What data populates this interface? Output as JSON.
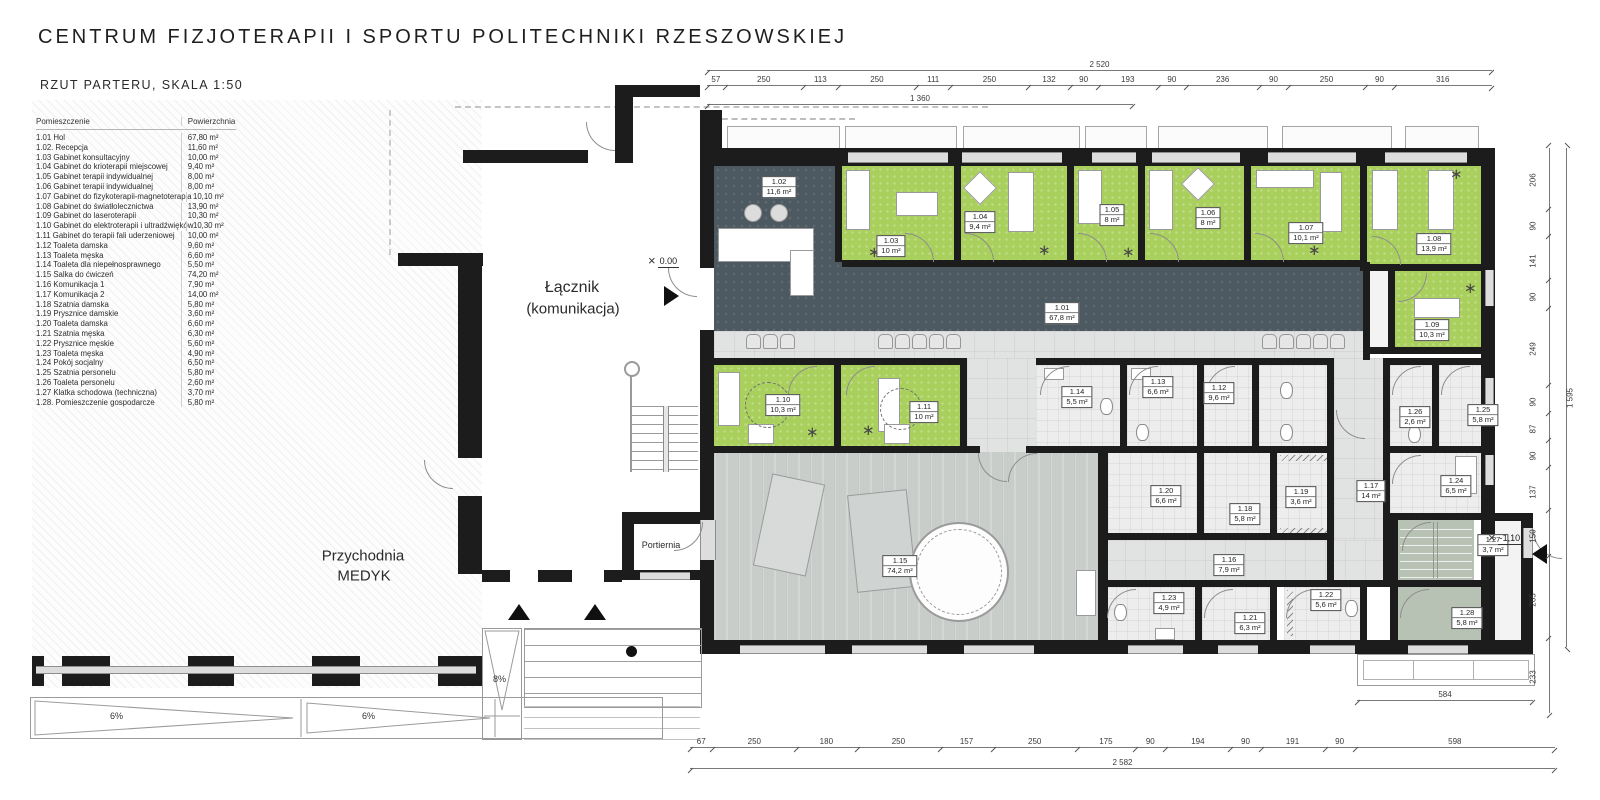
{
  "title": "CENTRUM FIZJOTERAPII I SPORTU POLITECHNIKI RZESZOWSKIEJ",
  "subtitle": "RZUT PARTERU, SKALA 1:50",
  "legend": {
    "col_room": "Pomieszczenie",
    "col_area": "Powierzchnia",
    "rows": [
      {
        "name": "1.01 Hol",
        "area": "67,80 m²"
      },
      {
        "name": "1.02. Recepcja",
        "area": "11,60 m²"
      },
      {
        "name": "1.03 Gabinet konsultacyjny",
        "area": "10,00 m²"
      },
      {
        "name": "1.04 Gabinet do krioterapii miejscowej",
        "area": "9,40 m²"
      },
      {
        "name": "1.05 Gabinet terapii indywidualnej",
        "area": "8,00 m²"
      },
      {
        "name": "1.06 Gabinet terapii indywidualnej",
        "area": "8,00 m²"
      },
      {
        "name": "1.07 Gabinet do fizykoterapii-magnetoterapia",
        "area": "10,10 m²"
      },
      {
        "name": "1.08 Gabinet do światłolecznictwa",
        "area": "13,90 m²"
      },
      {
        "name": "1.09 Gabinet do laseroterapii",
        "area": "10,30 m²"
      },
      {
        "name": "1.10 Gabinet do elektroterapii i ultradźwięków",
        "area": "10,30 m²"
      },
      {
        "name": "1.11 Gabinet do terapii fali uderzeniowej",
        "area": "10,00 m²"
      },
      {
        "name": "1.12 Toaleta damska",
        "area": "9,60 m²"
      },
      {
        "name": "1.13 Toaleta męska",
        "area": "6,60 m²"
      },
      {
        "name": "1.14 Toaleta dla niepełnosprawnego",
        "area": "5,50 m²"
      },
      {
        "name": "1.15 Salka do ćwiczeń",
        "area": "74,20 m²"
      },
      {
        "name": "1.16 Komunikacja 1",
        "area": "7,90 m²"
      },
      {
        "name": "1.17 Komunikacja 2",
        "area": "14,00 m²"
      },
      {
        "name": "1.18 Szatnia damska",
        "area": "5,80 m²"
      },
      {
        "name": "1.19 Prysznice damskie",
        "area": "3,60 m²"
      },
      {
        "name": "1.20 Toaleta damska",
        "area": "6,60 m²"
      },
      {
        "name": "1.21 Szatnia męska",
        "area": "6,30 m²"
      },
      {
        "name": "1.22 Prysznice męskie",
        "area": "5,60 m²"
      },
      {
        "name": "1.23 Toaleta męska",
        "area": "4,90 m²"
      },
      {
        "name": "1.24 Pokój socjalny",
        "area": "6,50 m²"
      },
      {
        "name": "1.25 Szatnia personelu",
        "area": "5,80 m²"
      },
      {
        "name": "1.26 Toaleta personelu",
        "area": "2,60 m²"
      },
      {
        "name": "1.27 Klatka schodowa (techniczna)",
        "area": "3,70 m²"
      },
      {
        "name": "1.28. Pomieszczenie gospodarcze",
        "area": "5,80 m²"
      }
    ]
  },
  "plan": {
    "connector_label_1": "Łącznik",
    "connector_label_2": "(komunikacja)",
    "medyk_label_1": "Przychodnia",
    "medyk_label_2": "MEDYK",
    "portiernia_label": "Portiernia",
    "level_zero": "0.00",
    "level_minus": "-1,10",
    "ramp_entry": "8%",
    "ramp_left_a": "6%",
    "ramp_left_b": "6%",
    "room_labels": [
      {
        "num": "1.01",
        "area": "67,8 m²",
        "x": 1062,
        "y": 313
      },
      {
        "num": "1.02",
        "area": "11,6 m²",
        "x": 779,
        "y": 187
      },
      {
        "num": "1.03",
        "area": "10 m²",
        "x": 891,
        "y": 246
      },
      {
        "num": "1.04",
        "area": "9,4 m²",
        "x": 980,
        "y": 222
      },
      {
        "num": "1.05",
        "area": "8 m²",
        "x": 1112,
        "y": 215
      },
      {
        "num": "1.06",
        "area": "8 m²",
        "x": 1208,
        "y": 218
      },
      {
        "num": "1.07",
        "area": "10,1 m²",
        "x": 1306,
        "y": 233
      },
      {
        "num": "1.08",
        "area": "13,9 m²",
        "x": 1434,
        "y": 244
      },
      {
        "num": "1.09",
        "area": "10,3 m²",
        "x": 1432,
        "y": 330
      },
      {
        "num": "1.10",
        "area": "10,3 m²",
        "x": 783,
        "y": 405
      },
      {
        "num": "1.11",
        "area": "10 m²",
        "x": 924,
        "y": 412
      },
      {
        "num": "1.12",
        "area": "9,6 m²",
        "x": 1219,
        "y": 393
      },
      {
        "num": "1.13",
        "area": "6,6 m²",
        "x": 1158,
        "y": 387
      },
      {
        "num": "1.14",
        "area": "5,5 m²",
        "x": 1077,
        "y": 397
      },
      {
        "num": "1.15",
        "area": "74,2 m²",
        "x": 900,
        "y": 566
      },
      {
        "num": "1.16",
        "area": "7,9 m²",
        "x": 1229,
        "y": 565
      },
      {
        "num": "1.17",
        "area": "14 m²",
        "x": 1371,
        "y": 491
      },
      {
        "num": "1.18",
        "area": "5,8 m²",
        "x": 1245,
        "y": 514
      },
      {
        "num": "1.19",
        "area": "3,6 m²",
        "x": 1301,
        "y": 497
      },
      {
        "num": "1.20",
        "area": "6,6 m²",
        "x": 1166,
        "y": 496
      },
      {
        "num": "1.21",
        "area": "6,3 m²",
        "x": 1250,
        "y": 623
      },
      {
        "num": "1.22",
        "area": "5,6 m²",
        "x": 1326,
        "y": 600
      },
      {
        "num": "1.23",
        "area": "4,9 m²",
        "x": 1169,
        "y": 603
      },
      {
        "num": "1.24",
        "area": "6,5 m²",
        "x": 1456,
        "y": 486
      },
      {
        "num": "1.25",
        "area": "5,8 m²",
        "x": 1483,
        "y": 415
      },
      {
        "num": "1.26",
        "area": "2,6 m²",
        "x": 1415,
        "y": 417
      },
      {
        "num": "1.27",
        "area": "3,7 m²",
        "x": 1493,
        "y": 545
      },
      {
        "num": "1.28",
        "area": "5,8 m²",
        "x": 1467,
        "y": 618
      }
    ]
  },
  "dimensions": {
    "top_total": "2 520",
    "top_segments": [
      "57",
      "250",
      "113",
      "250",
      "111",
      "250",
      "132",
      "90",
      "193",
      "90",
      "236",
      "90",
      "250",
      "90",
      "316"
    ],
    "top_sub": "1 360",
    "right_segments": [
      "206",
      "90",
      "141",
      "90",
      "249",
      "90",
      "87",
      "90",
      "137",
      "150",
      "265",
      "233"
    ],
    "right_total": "1 595",
    "bottom_segments": [
      "67",
      "250",
      "180",
      "250",
      "157",
      "250",
      "175",
      "90",
      "194",
      "90",
      "191",
      "90",
      "598"
    ],
    "bottom_total": "2 582",
    "terrace_dim": "584"
  },
  "colors": {
    "wall": "#1c1c1c",
    "treatment_green": "#a9cf5c",
    "hall_dark": "#4d5961",
    "corridor_tile": "#e1e3e2",
    "gym_wood": "#c8cdca",
    "technical_sage": "#b7c2b4"
  }
}
